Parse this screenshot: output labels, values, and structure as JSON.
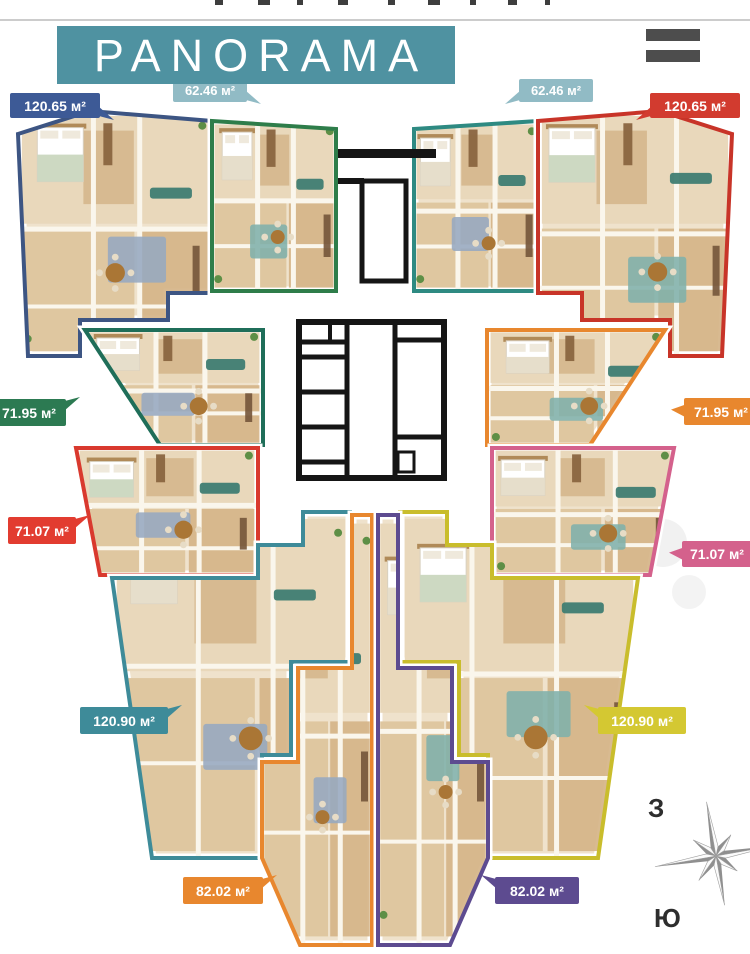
{
  "header": {
    "title": "PANORAMA",
    "banner_color": "#4f92a1",
    "menu_icon": "hamburger-icon"
  },
  "units": [
    {
      "id": "apartment-120-65-left",
      "area_label": "120.65 м²",
      "color": "#3d5a96",
      "outline": "#3d5583"
    },
    {
      "id": "apartment-62-46-left",
      "area_label": "62.46 м²",
      "color": "#4f93a3",
      "outline": "#2e7d4a"
    },
    {
      "id": "apartment-62-46-right",
      "area_label": "62.46 м²",
      "color": "#4f93a3",
      "outline": "#2e8a82"
    },
    {
      "id": "apartment-120-65-right",
      "area_label": "120.65 м²",
      "color": "#d23b2f",
      "outline": "#c83428"
    },
    {
      "id": "apartment-71-95-left",
      "area_label": "71.95 м²",
      "color": "#2c7a52",
      "outline": "#1f6e59"
    },
    {
      "id": "apartment-71-95-right",
      "area_label": "71.95 м²",
      "color": "#e8872e",
      "outline": "#e8872e"
    },
    {
      "id": "apartment-71-07-left",
      "area_label": "71.07 м²",
      "color": "#e23c30",
      "outline": "#d9392e"
    },
    {
      "id": "apartment-71-07-right",
      "area_label": "71.07 м²",
      "color": "#d4618c",
      "outline": "#d4618c"
    },
    {
      "id": "apartment-120-90-left",
      "area_label": "120.90 м²",
      "color": "#3e8b99",
      "outline": "#3e8b99"
    },
    {
      "id": "apartment-120-90-right",
      "area_label": "120.90 м²",
      "color": "#d4c832",
      "outline": "#c9bd2c"
    },
    {
      "id": "apartment-82-02-left",
      "area_label": "82.02 м²",
      "color": "#e8872e",
      "outline": "#e8872e"
    },
    {
      "id": "apartment-82-02-right",
      "area_label": "82.02 м²",
      "color": "#5d4b90",
      "outline": "#5d4b90"
    }
  ],
  "compass": {
    "icon": "compass-rose-icon",
    "west_label": "З",
    "south_label": "Ю"
  }
}
